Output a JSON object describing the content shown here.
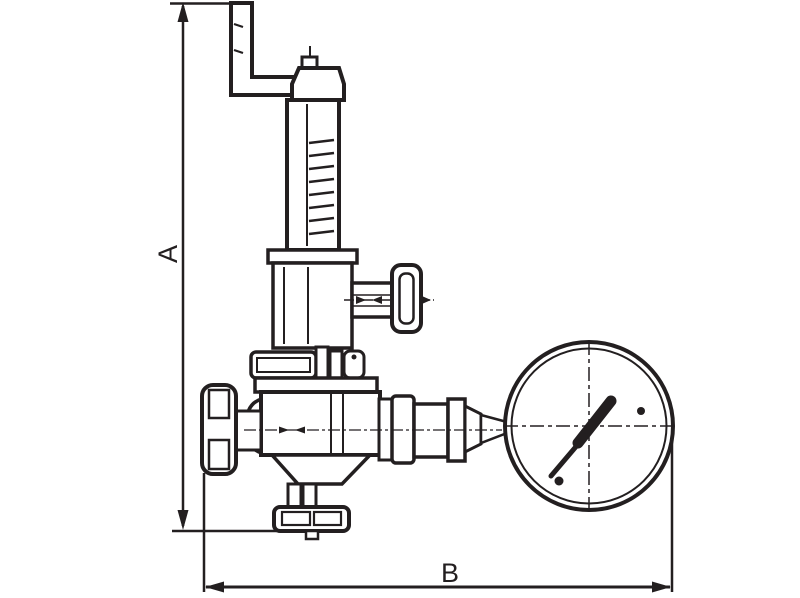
{
  "page": {
    "background_color": "#ffffff"
  },
  "drawing": {
    "type": "technical-line-drawing",
    "subject": "pressure-reducing-valve-with-manometer",
    "ink_color": "#231f20",
    "dimensions": {
      "a_label": "A",
      "b_label": "B"
    },
    "parts": [
      "inlet-pipe-elbow",
      "bonnet-cap",
      "spring-housing",
      "adjuster-body",
      "side-tap-stem",
      "side-tap-handle",
      "mid-flange",
      "valve-body",
      "handwheel",
      "bottom-outlet-flange",
      "gauge-union",
      "pressure-gauge"
    ]
  }
}
